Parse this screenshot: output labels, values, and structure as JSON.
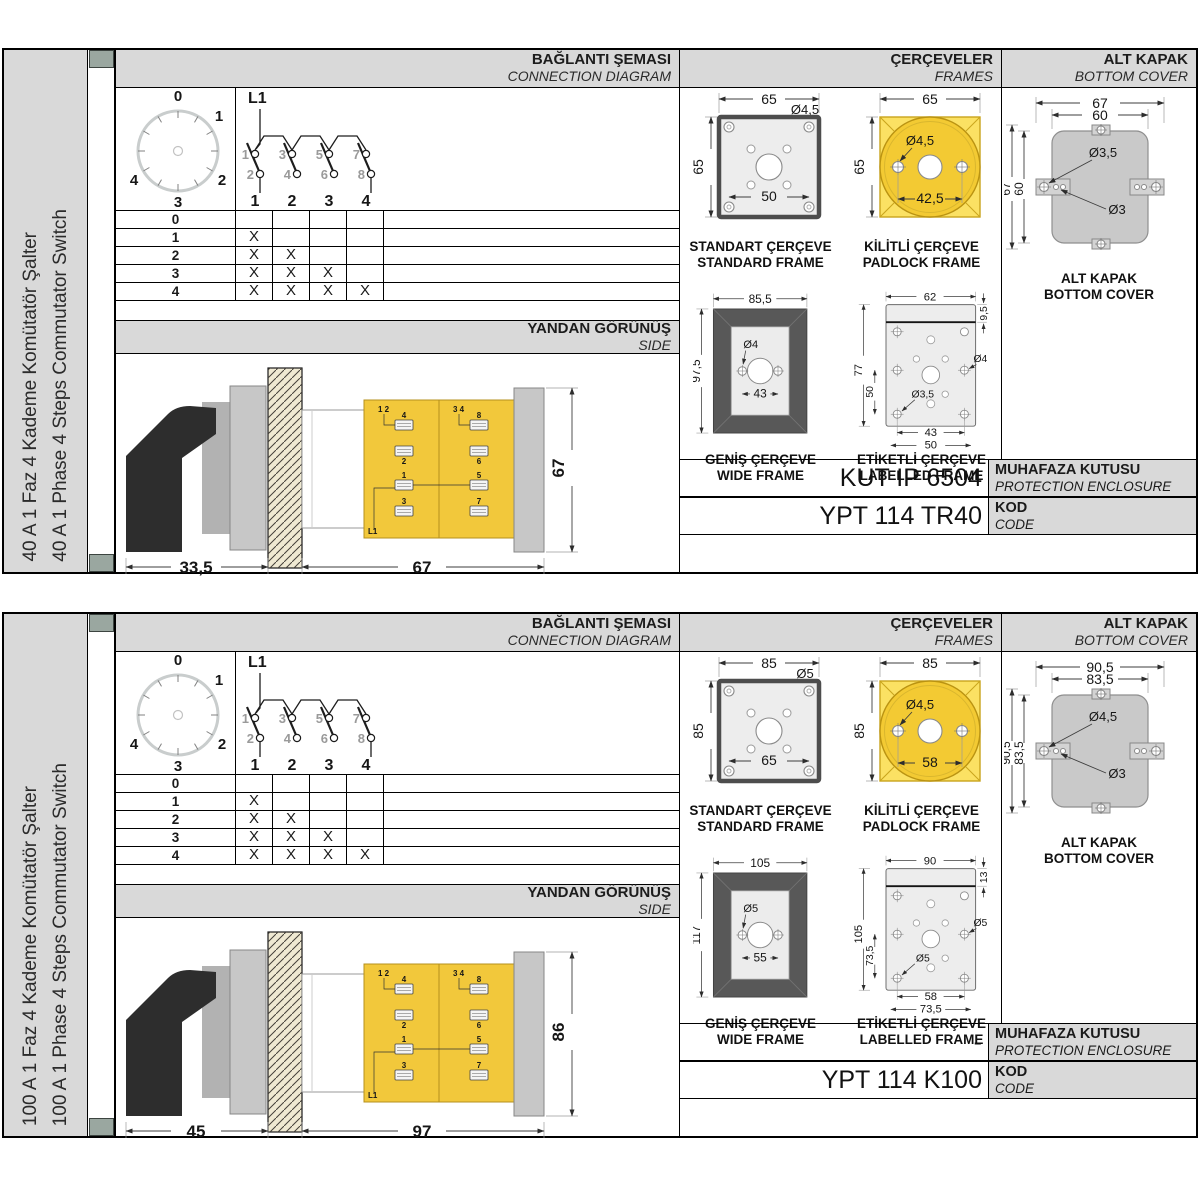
{
  "colors": {
    "accent_yellow": "#f2c83b",
    "padlock_yellow": "#f3ca33",
    "header_gray": "#d9d9d9",
    "corner_square_green": "#9aa7a0",
    "wide_frame_dark": "#585858",
    "cover_gray": "#c9c9c9"
  },
  "sections": [
    {
      "sidebar": {
        "label_tr": "40 A 1 Faz 4 Kademe Komütatör Şalter",
        "label_en": "40 A 1 Phase 4 Steps Commutator Switch"
      },
      "headers": {
        "connection_tr": "BAĞLANTI ŞEMASI",
        "connection_en": "CONNECTION DIAGRAM",
        "frames_tr": "ÇERÇEVELER",
        "frames_en": "FRAMES",
        "cover_tr": "ALT KAPAK",
        "cover_en": "BOTTOM COVER",
        "side_tr": "YANDAN GÖRÜNÜŞ",
        "side_en": "SIDE"
      },
      "dial": {
        "positions": [
          "0",
          "1",
          "2",
          "3",
          "4"
        ]
      },
      "contacts": {
        "l1": "L1",
        "top": [
          "1",
          "3",
          "5",
          "7"
        ],
        "bottom": [
          "2",
          "4",
          "6",
          "8"
        ],
        "poles": [
          "1",
          "2",
          "3",
          "4"
        ]
      },
      "table": {
        "rows": [
          {
            "label": "0",
            "marks": [
              "",
              "",
              "",
              ""
            ]
          },
          {
            "label": "1",
            "marks": [
              "X",
              "",
              "",
              ""
            ]
          },
          {
            "label": "2",
            "marks": [
              "X",
              "X",
              "",
              ""
            ]
          },
          {
            "label": "3",
            "marks": [
              "X",
              "X",
              "X",
              ""
            ]
          },
          {
            "label": "4",
            "marks": [
              "X",
              "X",
              "X",
              "X"
            ]
          }
        ]
      },
      "side_view": {
        "dim_handle": "33,5",
        "dim_body": "67",
        "dim_height": "67",
        "labels": {
          "pair1": "1 2",
          "pair2": "3 4",
          "n4": "4",
          "n2": "2",
          "n8": "8",
          "n6": "6",
          "n1": "1",
          "n3": "3",
          "n5": "5",
          "n7": "7",
          "l1": "L1"
        }
      },
      "frames": {
        "standard": {
          "dim_w": "65",
          "dim_h": "65",
          "hole": "Ø4,5",
          "pitch": "50",
          "caption_tr": "STANDART ÇERÇEVE",
          "caption_en": "STANDARD FRAME"
        },
        "padlock": {
          "dim_w": "65",
          "dim_h": "65",
          "hole": "Ø4,5",
          "pitch": "42,5",
          "caption_tr": "KİLİTLİ ÇERÇEVE",
          "caption_en": "PADLOCK FRAME"
        },
        "wide": {
          "dim_w": "85,5",
          "dim_h": "97,5",
          "hole": "Ø4",
          "pitch": "43",
          "caption_tr": "GENİŞ ÇERÇEVE",
          "caption_en": "WIDE FRAME"
        },
        "labelled": {
          "dim_w": "62",
          "strip": "9,5",
          "dim_h": "77",
          "inner_h": "50",
          "hole_right": "Ø4",
          "hole_left": "Ø3,5",
          "pitch1": "43",
          "pitch2": "50",
          "caption_tr": "ETİKETLİ ÇERÇEVE",
          "caption_en": "LABELLED FRAME"
        }
      },
      "cover": {
        "dim_w_out": "67",
        "dim_w_in": "60",
        "dim_h_out": "67",
        "dim_h_in": "60",
        "hole_big": "Ø3,5",
        "hole_small": "Ø3",
        "caption_tr": "ALT KAPAK",
        "caption_en": "BOTTOM COVER"
      },
      "codes": {
        "enclosure_value": "KUT IP 6504",
        "enclosure_label_tr": "MUHAFAZA KUTUSU",
        "enclosure_label_en": "PROTECTION ENCLOSURE",
        "code_value": "YPT 114 TR40",
        "code_label_tr": "KOD",
        "code_label_en": "CODE"
      }
    },
    {
      "sidebar": {
        "label_tr": "100 A 1 Faz 4 Kademe Komütatör Şalter",
        "label_en": "100 A 1 Phase 4 Steps Commutator Switch"
      },
      "headers": {
        "connection_tr": "BAĞLANTI ŞEMASI",
        "connection_en": "CONNECTION DIAGRAM",
        "frames_tr": "ÇERÇEVELER",
        "frames_en": "FRAMES",
        "cover_tr": "ALT KAPAK",
        "cover_en": "BOTTOM COVER",
        "side_tr": "YANDAN GÖRÜNÜŞ",
        "side_en": "SIDE"
      },
      "dial": {
        "positions": [
          "0",
          "1",
          "2",
          "3",
          "4"
        ]
      },
      "contacts": {
        "l1": "L1",
        "top": [
          "1",
          "3",
          "5",
          "7"
        ],
        "bottom": [
          "2",
          "4",
          "6",
          "8"
        ],
        "poles": [
          "1",
          "2",
          "3",
          "4"
        ]
      },
      "table": {
        "rows": [
          {
            "label": "0",
            "marks": [
              "",
              "",
              "",
              ""
            ]
          },
          {
            "label": "1",
            "marks": [
              "X",
              "",
              "",
              ""
            ]
          },
          {
            "label": "2",
            "marks": [
              "X",
              "X",
              "",
              ""
            ]
          },
          {
            "label": "3",
            "marks": [
              "X",
              "X",
              "X",
              ""
            ]
          },
          {
            "label": "4",
            "marks": [
              "X",
              "X",
              "X",
              "X"
            ]
          }
        ]
      },
      "side_view": {
        "dim_handle": "45",
        "dim_body": "97",
        "dim_height": "86",
        "labels": {
          "pair1": "1 2",
          "pair2": "3 4",
          "n4": "4",
          "n2": "2",
          "n8": "8",
          "n6": "6",
          "n1": "1",
          "n3": "3",
          "n5": "5",
          "n7": "7",
          "l1": "L1"
        }
      },
      "frames": {
        "standard": {
          "dim_w": "85",
          "dim_h": "85",
          "hole": "Ø5",
          "pitch": "65",
          "caption_tr": "STANDART ÇERÇEVE",
          "caption_en": "STANDARD FRAME"
        },
        "padlock": {
          "dim_w": "85",
          "dim_h": "85",
          "hole": "Ø4,5",
          "pitch": "58",
          "caption_tr": "KİLİTLİ ÇERÇEVE",
          "caption_en": "PADLOCK FRAME"
        },
        "wide": {
          "dim_w": "105",
          "dim_h": "117",
          "hole": "Ø5",
          "pitch": "55",
          "caption_tr": "GENİŞ ÇERÇEVE",
          "caption_en": "WIDE FRAME"
        },
        "labelled": {
          "dim_w": "90",
          "strip": "13",
          "dim_h": "105",
          "inner_h": "73,5",
          "hole_right": "Ø5",
          "hole_left": "Ø5",
          "pitch1": "58",
          "pitch2": "73,5",
          "caption_tr": "ETİKETLİ ÇERÇEVE",
          "caption_en": "LABELLED FRAME"
        }
      },
      "cover": {
        "dim_w_out": "90,5",
        "dim_w_in": "83,5",
        "dim_h_out": "90,5",
        "dim_h_in": "83,5",
        "hole_big": "Ø4,5",
        "hole_small": "Ø3",
        "caption_tr": "ALT KAPAK",
        "caption_en": "BOTTOM COVER"
      },
      "codes": {
        "enclosure_value": "-",
        "enclosure_label_tr": "MUHAFAZA KUTUSU",
        "enclosure_label_en": "PROTECTION ENCLOSURE",
        "code_value": "YPT 114 K100",
        "code_label_tr": "KOD",
        "code_label_en": "CODE"
      }
    }
  ]
}
